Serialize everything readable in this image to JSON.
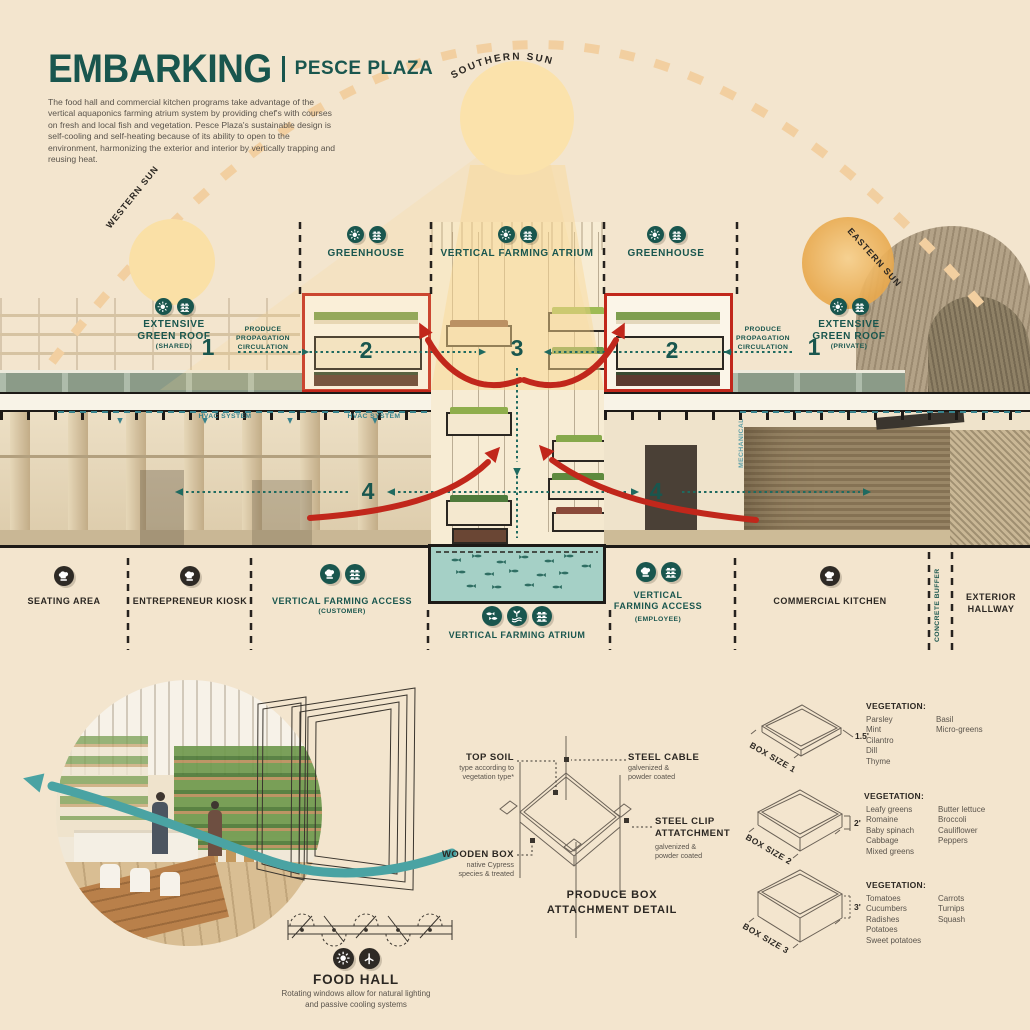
{
  "header": {
    "title": "EMBARKING",
    "subtitle": "PESCE PLAZA",
    "description": "The food hall and commercial kitchen programs take advantage of the vertical aquaponics farming atrium system by providing chef's with courses on fresh and local fish and vegetation. Pesce Plaza's sustainable design is self-cooling and self-heating because of its ability to open to the environment, harmonizing the exterior and interior by vertically trapping and reusing heat."
  },
  "suns": {
    "southern": "SOUTHERN SUN",
    "western": "WESTERN SUN",
    "eastern": "EASTERN SUN"
  },
  "section": {
    "zone_labels": [
      {
        "label": "GREENHOUSE"
      },
      {
        "label": "VERTICAL FARMING ATRIUM"
      },
      {
        "label": "GREENHOUSE"
      }
    ],
    "green_roof_shared": {
      "title": "EXTENSIVE\nGREEN ROOF",
      "note": "(SHARED)"
    },
    "green_roof_private": {
      "title": "EXTENSIVE\nGREEN ROOF",
      "note": "(PRIVATE)"
    },
    "produce_circulation": "PRODUCE\nPROPAGATION\nCIRCULATION",
    "hvac_label": "HVAC SYSTEM",
    "mechanical_label": "MECHANICAL",
    "callouts": {
      "one": "1",
      "two": "2",
      "three": "3",
      "four": "4"
    }
  },
  "program_row": {
    "items": [
      {
        "label": "SEATING AREA"
      },
      {
        "label": "ENTREPRENEUR KIOSK"
      },
      {
        "label": "VERTICAL FARMING ACCESS",
        "sub": "(CUSTOMER)"
      },
      {
        "label": "VERTICAL FARMING ATRIUM"
      },
      {
        "label": "VERTICAL\nFARMING ACCESS",
        "sub": "(EMPLOYEE)"
      },
      {
        "label": "COMMERCIAL KITCHEN"
      },
      {
        "label": "CONCRETE BUFFER"
      },
      {
        "label": "EXTERIOR\nHALLWAY"
      }
    ]
  },
  "detail": {
    "top_soil": {
      "title": "TOP SOIL",
      "sub": "type according to\nvegetation type*"
    },
    "steel_cable": {
      "title": "STEEL CABLE",
      "sub": "galvenized &\npowder coated"
    },
    "steel_clip": {
      "title": "STEEL CLIP\nATTATCHMENT",
      "sub": "galvenized &\npowder coated"
    },
    "wooden_box": {
      "title": "WOODEN BOX",
      "sub": "native Cypress\nspecies & treated"
    },
    "caption": "PRODUCE BOX\nATTACHMENT DETAIL"
  },
  "box_sizes": [
    {
      "name": "BOX SIZE 1",
      "dimension": "1.5'",
      "heading": "VEGETATION:",
      "col1": [
        "Parsley",
        "Mint",
        "Cilantro",
        "Dill",
        "Thyme"
      ],
      "col2": [
        "Basil",
        "Micro-greens"
      ]
    },
    {
      "name": "BOX SIZE 2",
      "dimension": "2'",
      "heading": "VEGETATION:",
      "col1": [
        "Leafy greens",
        "Romaine",
        "Baby spinach",
        "Cabbage",
        "Mixed greens"
      ],
      "col2": [
        "Butter lettuce",
        "Broccoli",
        "Cauliflower",
        "Peppers"
      ]
    },
    {
      "name": "BOX SIZE 3",
      "dimension": "3'",
      "heading": "VEGETATION:",
      "col1": [
        "Tomatoes",
        "Cucumbers",
        "Radishes",
        "Potatoes",
        "Sweet potatoes"
      ],
      "col2": [
        "Carrots",
        "Turnips",
        "Squash"
      ]
    }
  ],
  "food_hall": {
    "title": "FOOD HALL",
    "description": "Rotating windows allow for natural lighting\nand passive cooling systems"
  },
  "colors": {
    "teal": "#19564E",
    "arrow_teal": "#1F6A60",
    "red": "#C1271B",
    "sun": "#FBE2AB",
    "background": "#F3E5CE",
    "water": "#A5D0C6",
    "wave_teal": "#4AA3A3",
    "ink": "#2B2722"
  }
}
